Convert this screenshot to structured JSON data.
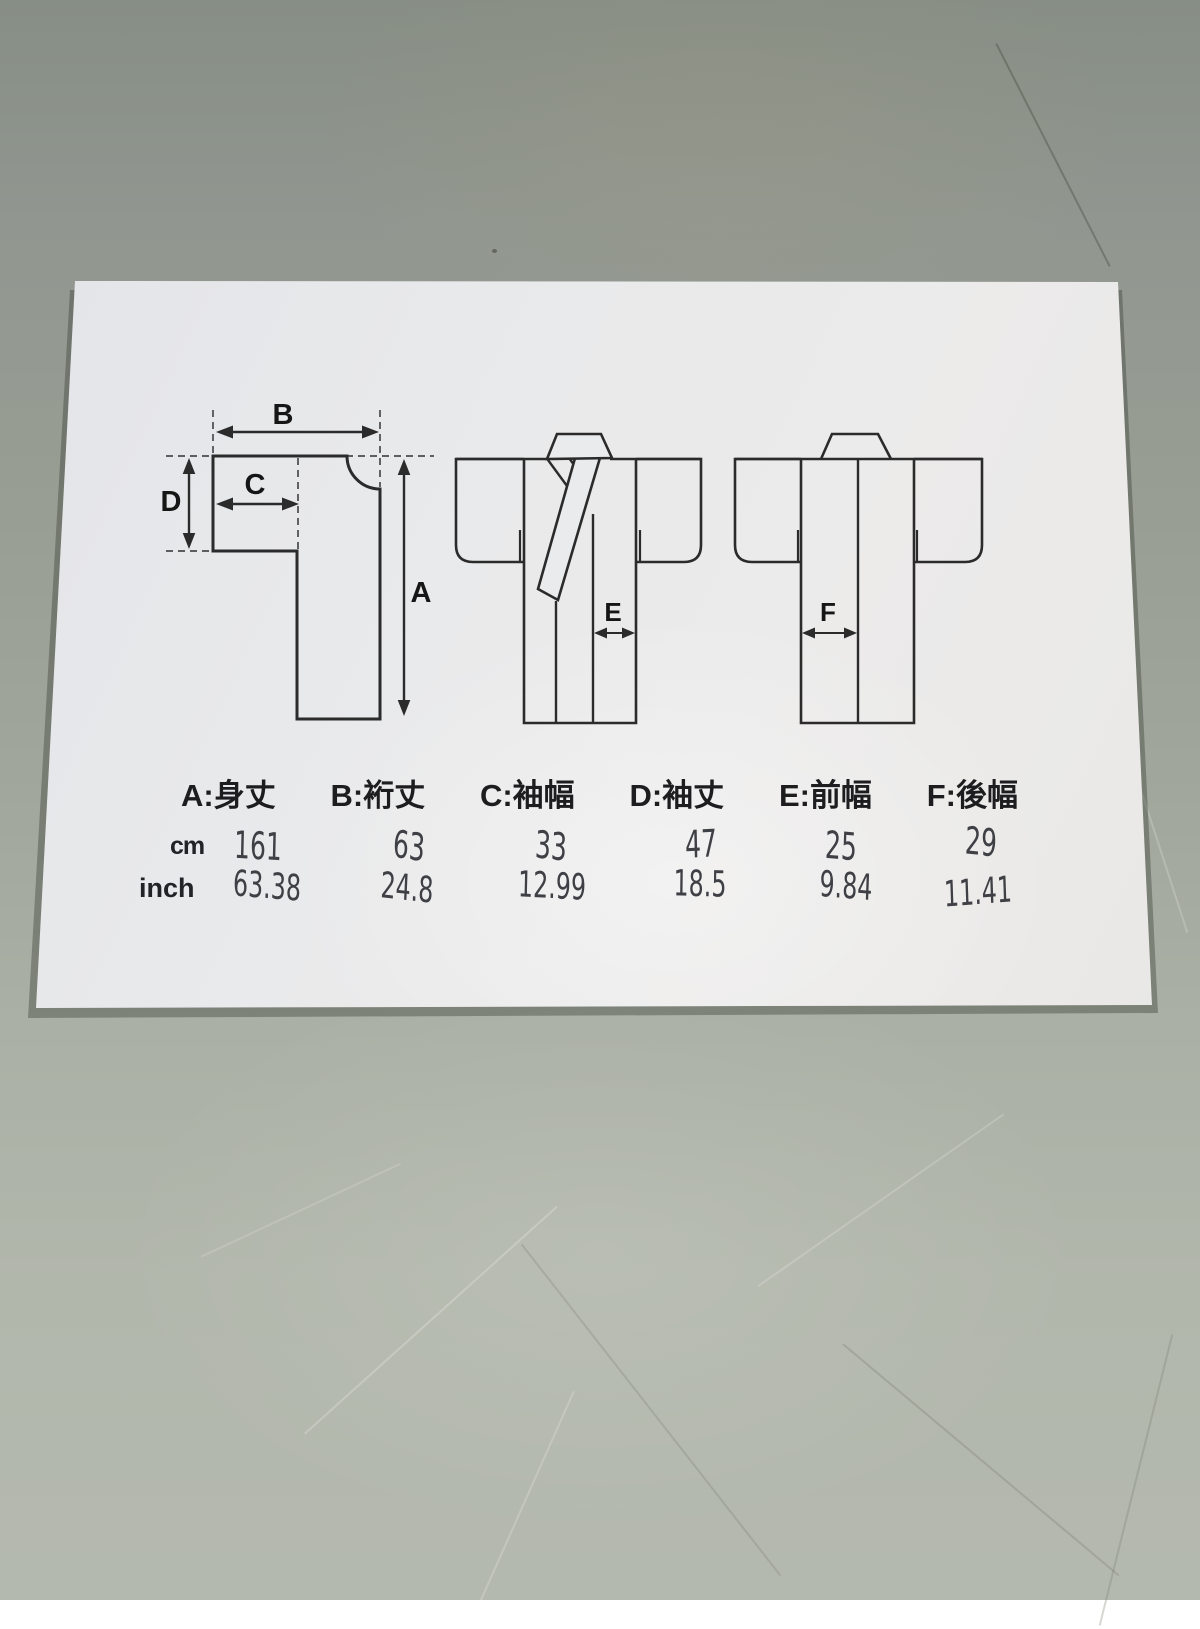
{
  "diagram_labels": {
    "a": "A",
    "b": "B",
    "c": "C",
    "d": "D",
    "e": "E",
    "f": "F"
  },
  "legend": {
    "items": [
      "A:身丈",
      "B:裄丈",
      "C:袖幅",
      "D:袖丈",
      "E:前幅",
      "F:後幅"
    ]
  },
  "size_table": {
    "rows": [
      {
        "label": "cm",
        "values": [
          "161",
          "63",
          "33",
          "47",
          "25",
          "29"
        ]
      },
      {
        "label": "inch",
        "values": [
          "63.38",
          "24.8",
          "12.99",
          "18.5",
          "9.84",
          "11.41"
        ]
      }
    ]
  },
  "colors": {
    "table_surface": "#9aa095",
    "paper": "#e9eaec",
    "diagram_ink": "#2b2b2b",
    "handwriting_ink": "#3f4046"
  }
}
